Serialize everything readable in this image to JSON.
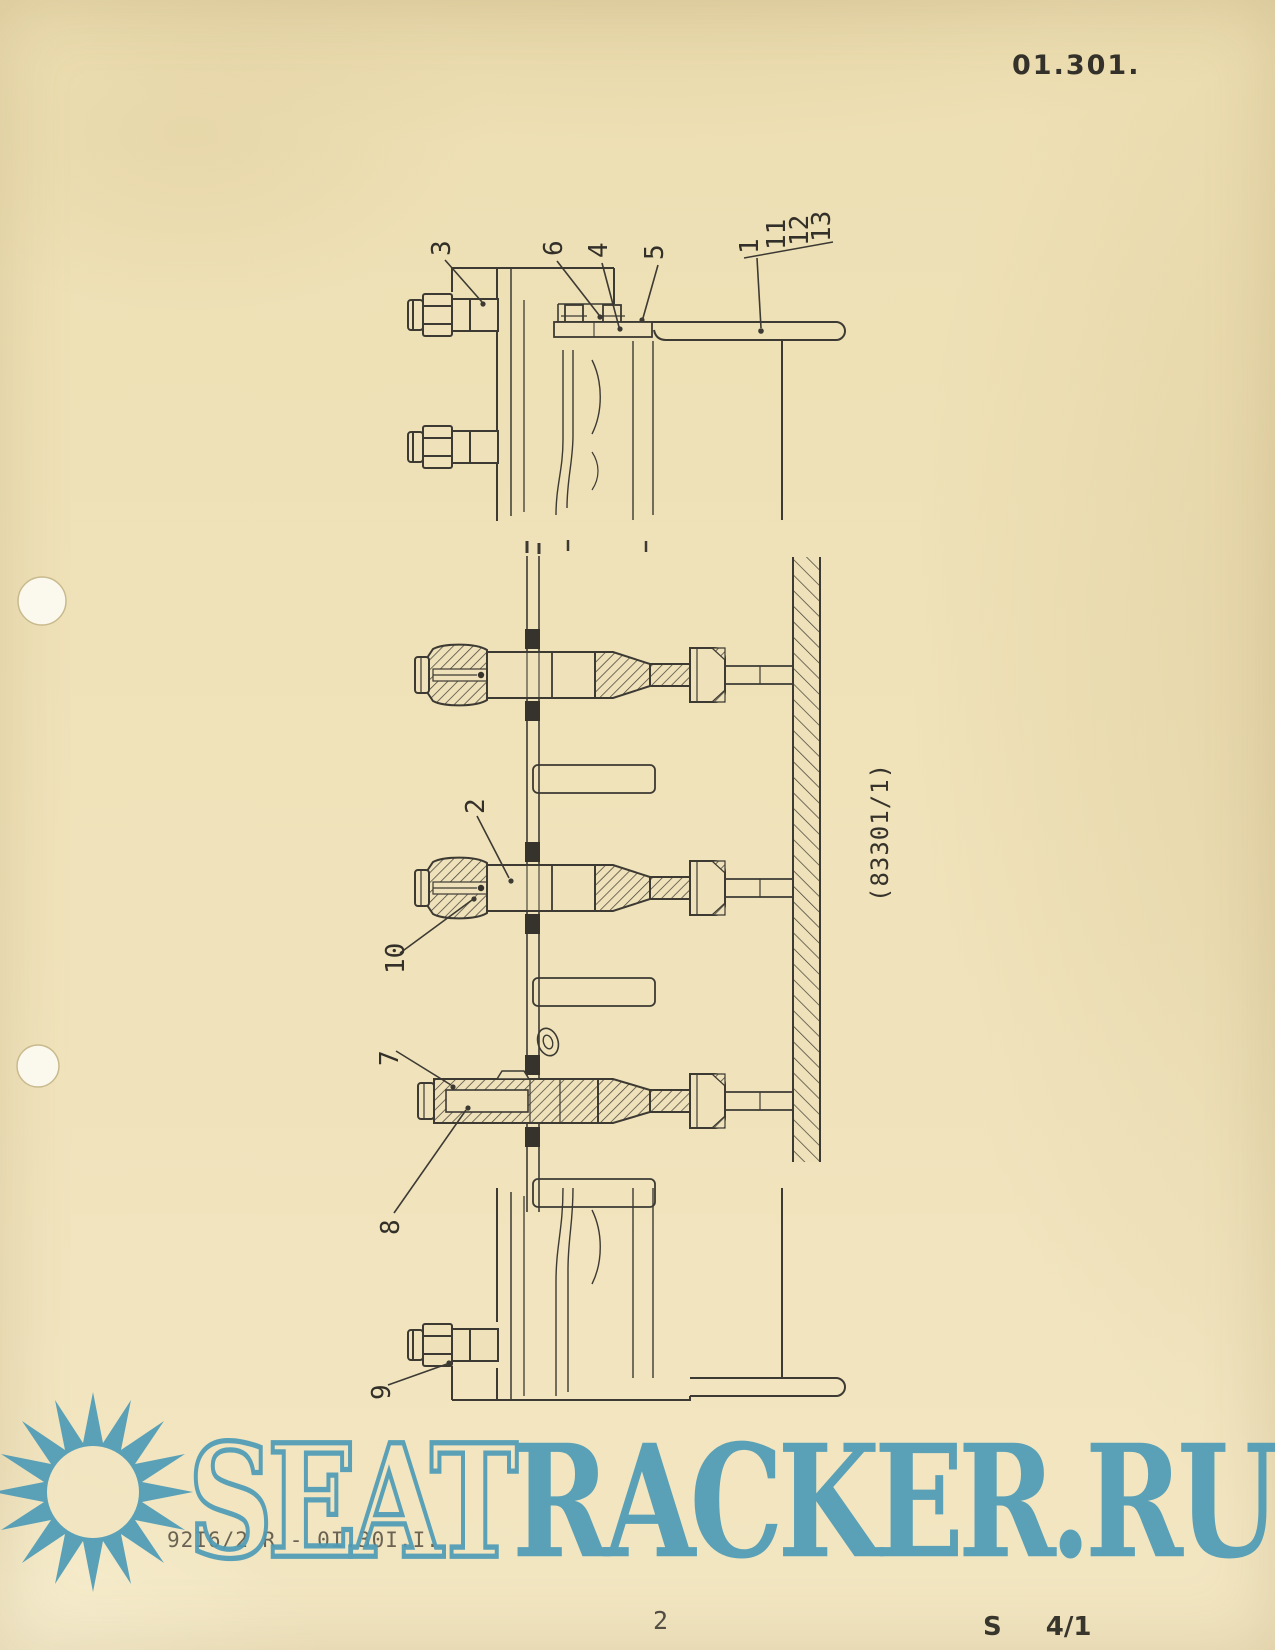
{
  "page": {
    "doc_code": "01.301.",
    "page_number": "2",
    "sheet_label": "S",
    "sheet_value": "4/1",
    "footer_code": "92I6/2 R - 0I.30I.I."
  },
  "diagram": {
    "figure_ref": "(83301/1)",
    "callouts": {
      "n1": "1",
      "n2": "2",
      "n3": "3",
      "n4": "4",
      "n5": "5",
      "n6": "6",
      "n7": "7",
      "n8": "8",
      "n9": "9",
      "n10": "10",
      "n11": "11",
      "n12": "12",
      "n13": "13"
    }
  },
  "watermark": {
    "text_outline": "SEAT",
    "text_solid": "RACKER.RU",
    "color": "#4f9cb7"
  }
}
